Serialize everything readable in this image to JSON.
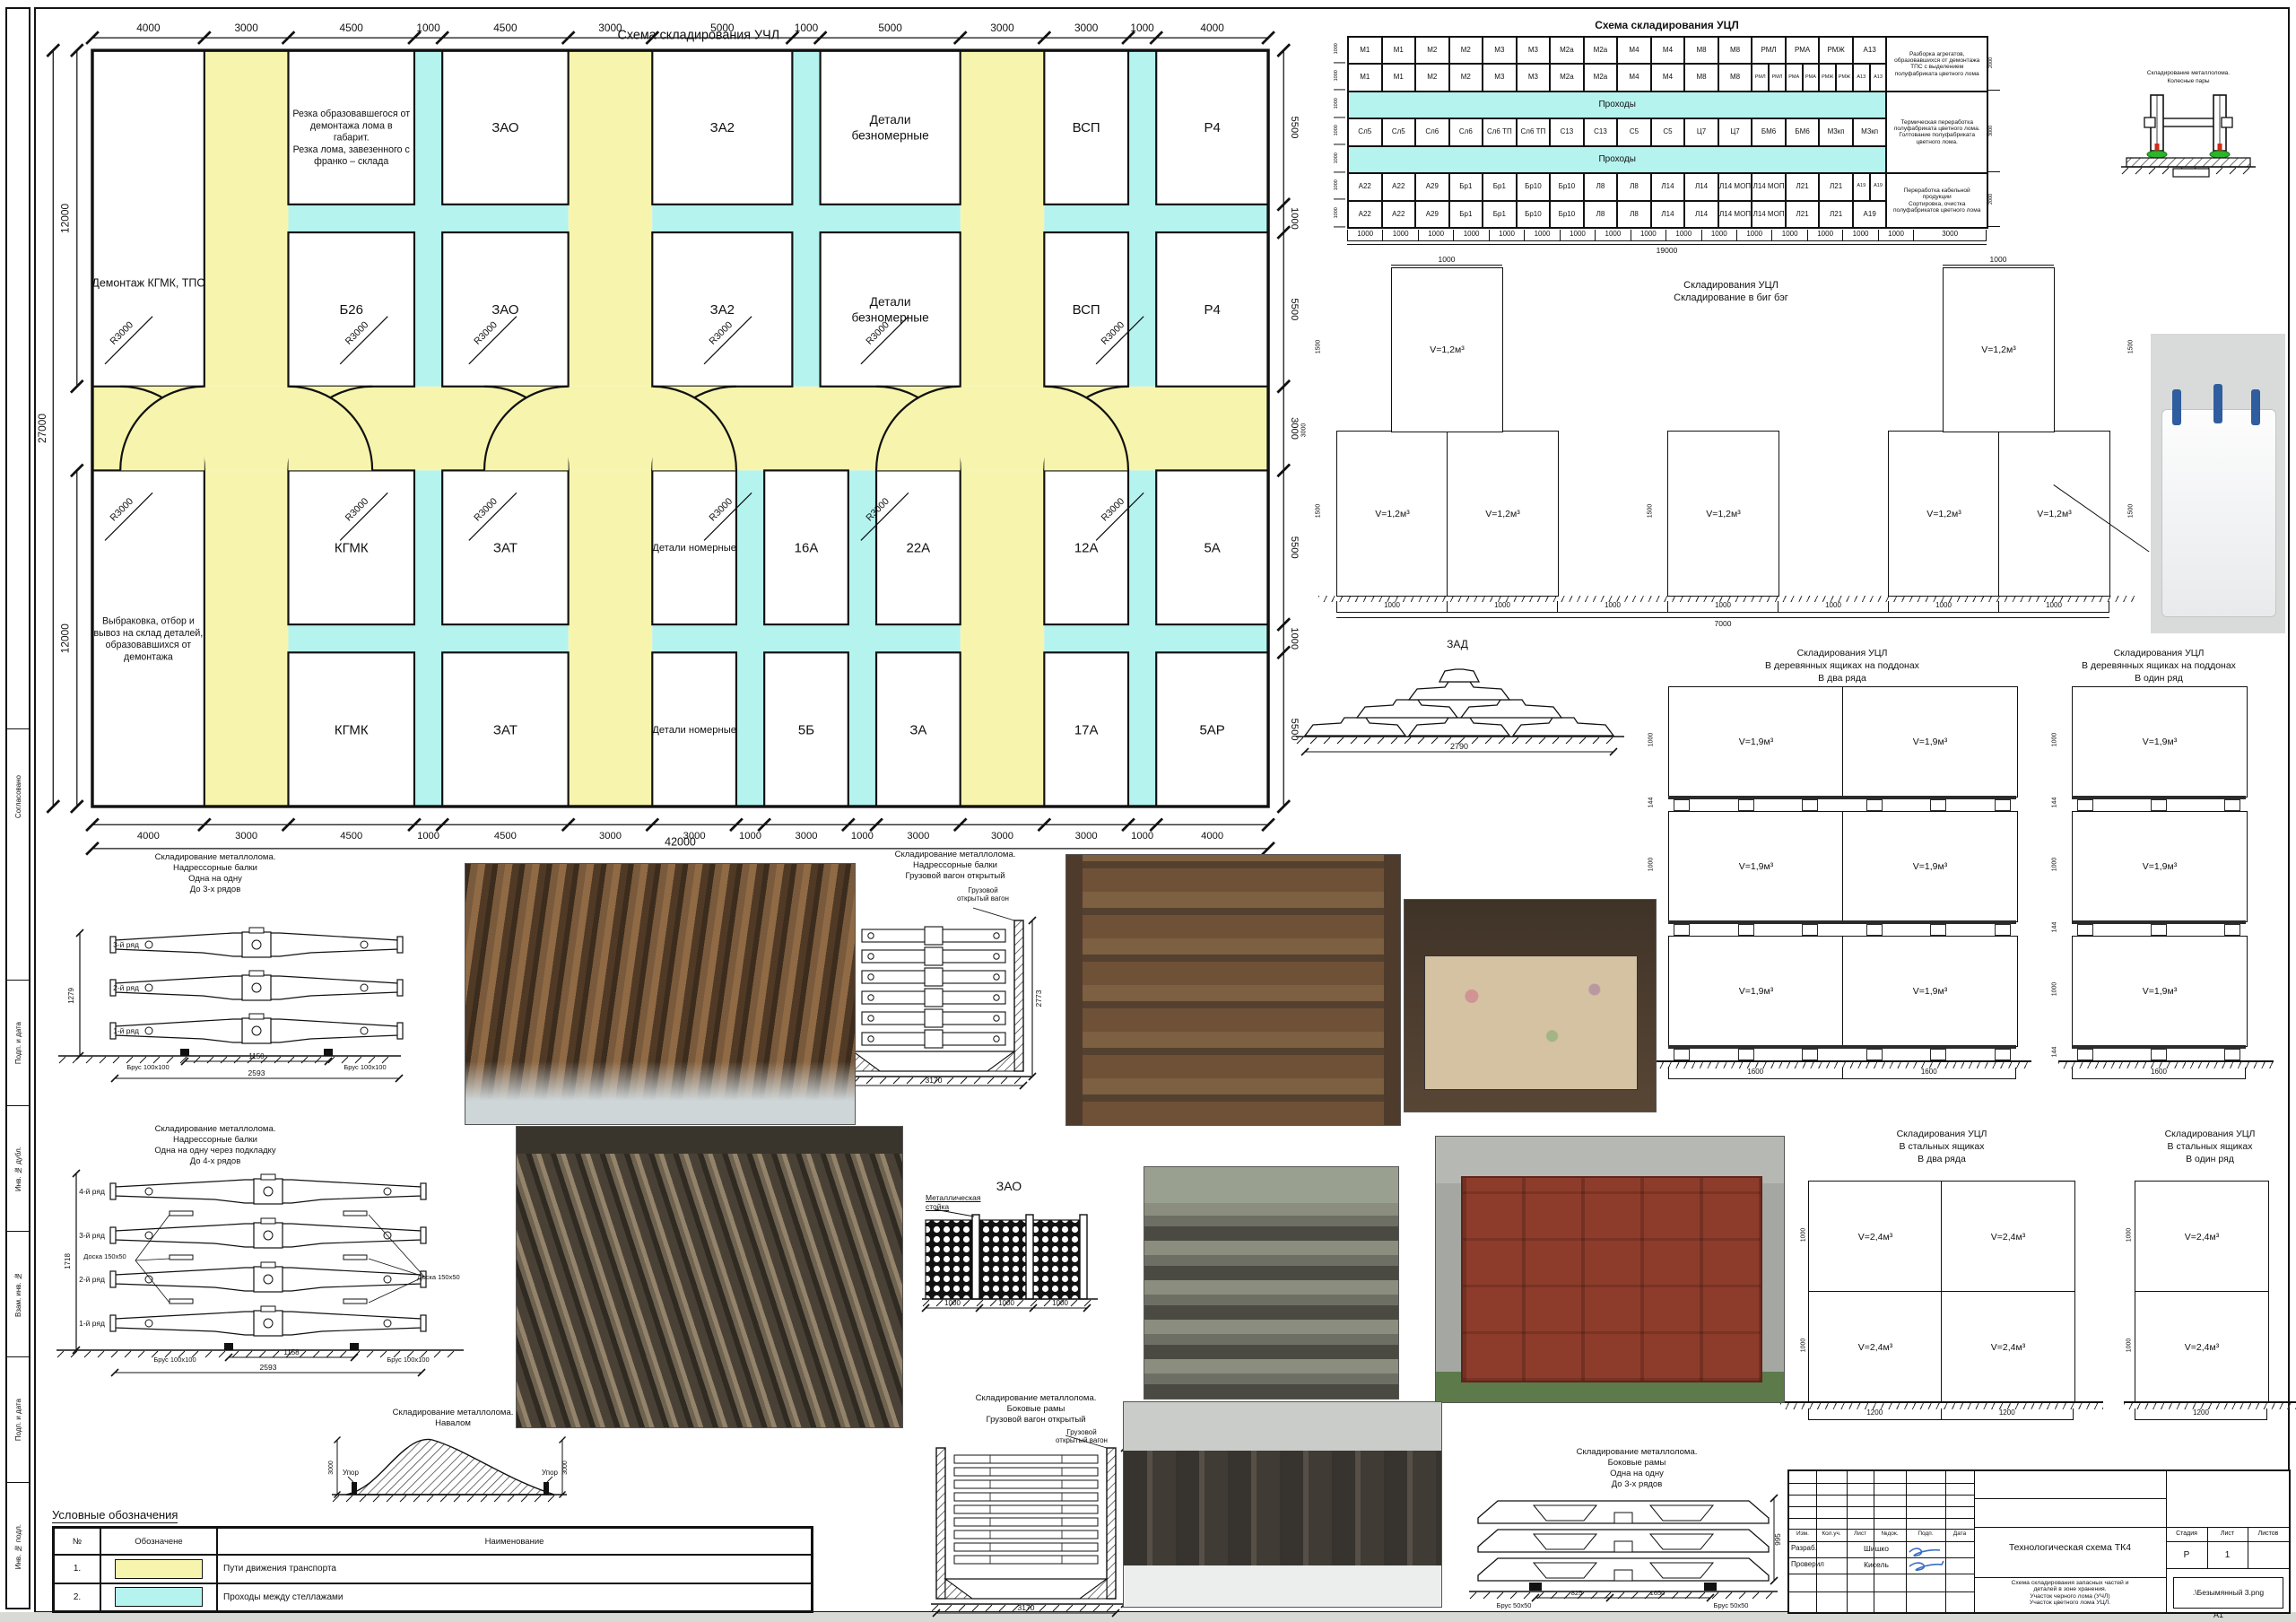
{
  "sheet": {
    "format_label": "А1"
  },
  "colors": {
    "path_yellow": "#f7f5ad",
    "aisle_cyan": "#b5f3ef",
    "line": "#141414",
    "signature_blue": "#3a6fc4"
  },
  "uchl": {
    "title": "Схема складирования УЧЛ",
    "top_dims": [
      4000,
      3000,
      4500,
      1000,
      4500,
      3000,
      5000,
      1000,
      5000,
      3000,
      3000,
      1000,
      4000
    ],
    "bottom_dims": [
      4000,
      3000,
      4500,
      1000,
      4500,
      3000,
      3000,
      1000,
      3000,
      1000,
      3000,
      3000,
      3000,
      1000,
      4000
    ],
    "bottom_total": "42000",
    "left_top": "12000",
    "left_total": "27000",
    "left_bottom": "12000",
    "right_dims": [
      "5500",
      "1000",
      "5500",
      "3000",
      "5500",
      "1000",
      "5500"
    ],
    "radius_label": "R3000",
    "cell_demontazh": "Демонтаж КГМК, ТПС",
    "cell_rezka": "Резка образовавшегося от\nдемонтажа лома в\nгабарит.\nРезка лома, завезенного с\nфранко – склада",
    "cell_vybrakovka": "Выбраковка, отбор и\nвывоз на склад деталей,\nобразовавшихся от\nдемонтажа",
    "row1": [
      "ЗАО",
      "ЗА2",
      "Детали\nбезномерные",
      "ВСП",
      "Р4"
    ],
    "row2": [
      "Б26",
      "ЗАО",
      "ЗА2",
      "Детали\nбезномерные",
      "ВСП",
      "Р4"
    ],
    "row3": [
      "КГМК",
      "ЗАТ",
      "Детали номерные",
      "16А",
      "22А",
      "12А",
      "5А"
    ],
    "row4": [
      "КГМК",
      "ЗАТ",
      "Детали номерные",
      "5Б",
      "ЗА",
      "17А",
      "5АР"
    ]
  },
  "ucl_table": {
    "title": "Схема складирования УЦЛ",
    "rows": [
      {
        "cells": [
          {
            "t": "М1"
          },
          {
            "t": "М1"
          },
          {
            "t": "М2"
          },
          {
            "t": "М2"
          },
          {
            "t": "М3"
          },
          {
            "t": "М3"
          },
          {
            "t": "М2а"
          },
          {
            "t": "М2а"
          },
          {
            "t": "М4"
          },
          {
            "t": "М4"
          },
          {
            "t": "М8"
          },
          {
            "t": "М8"
          },
          {
            "t": "РМЛ"
          },
          {
            "t": "РМА"
          },
          {
            "t": "РМЖ"
          },
          {
            "t": "А13"
          },
          {
            "t": "Разборка агрегатов, образовавшихся от демонтажа ТПС с выделением полуфабриката цветного лома",
            "side": true,
            "rspan": 2
          }
        ]
      },
      {
        "cells": [
          {
            "t": "М1"
          },
          {
            "t": "М1"
          },
          {
            "t": "М2"
          },
          {
            "t": "М2"
          },
          {
            "t": "М3"
          },
          {
            "t": "М3"
          },
          {
            "t": "М2а"
          },
          {
            "t": "М2а"
          },
          {
            "t": "М4"
          },
          {
            "t": "М4"
          },
          {
            "t": "М8"
          },
          {
            "t": "М8"
          },
          {
            "t": "РМЛ",
            "half": true
          },
          {
            "t": "РМЛ",
            "half": true
          },
          {
            "t": "РМА",
            "half": true
          },
          {
            "t": "РМА",
            "half": true
          },
          {
            "t": "РМЖ",
            "half": true
          },
          {
            "t": "РМЖ",
            "half": true
          },
          {
            "t": "А13",
            "half": true
          },
          {
            "t": "А13",
            "half": true
          }
        ]
      },
      {
        "cells": [
          {
            "t": "Проходы",
            "passage": true
          },
          {
            "t": "Термическая переработка полуфабриката цветного лома.\nГолтование полуфабриката цветного лома.",
            "side": true,
            "rspan": 3
          }
        ]
      },
      {
        "cells": [
          {
            "t": "Сл5"
          },
          {
            "t": "Сл5"
          },
          {
            "t": "Сл6"
          },
          {
            "t": "Сл6"
          },
          {
            "t": "Сл6 ТП"
          },
          {
            "t": "Сл6 ТП"
          },
          {
            "t": "С13"
          },
          {
            "t": "С13"
          },
          {
            "t": "С5"
          },
          {
            "t": "С5"
          },
          {
            "t": "Ц7"
          },
          {
            "t": "Ц7"
          },
          {
            "t": "БМ6"
          },
          {
            "t": "БМ6"
          },
          {
            "t": "М3кп"
          },
          {
            "t": "М3кп"
          }
        ]
      },
      {
        "cells": [
          {
            "t": "Проходы",
            "passage": true
          }
        ]
      },
      {
        "cells": [
          {
            "t": "А22"
          },
          {
            "t": "А22"
          },
          {
            "t": "А29"
          },
          {
            "t": "Бр1"
          },
          {
            "t": "Бр1"
          },
          {
            "t": "Бр10"
          },
          {
            "t": "Бр10"
          },
          {
            "t": "Л8"
          },
          {
            "t": "Л8"
          },
          {
            "t": "Л14"
          },
          {
            "t": "Л14"
          },
          {
            "t": "Л14 МОП"
          },
          {
            "t": "Л14 МОП"
          },
          {
            "t": "Л21"
          },
          {
            "t": "Л21"
          },
          {
            "t": "А19",
            "half": true
          },
          {
            "t": "А19",
            "half": true
          },
          {
            "t": "Переработка кабельной продукции\nСортировка, очистка\nполуфабрикатов цветного лома",
            "side": true,
            "rspan": 2
          }
        ]
      },
      {
        "cells": [
          {
            "t": "А22"
          },
          {
            "t": "А22"
          },
          {
            "t": "А29"
          },
          {
            "t": "Бр1"
          },
          {
            "t": "Бр1"
          },
          {
            "t": "Бр10"
          },
          {
            "t": "Бр10"
          },
          {
            "t": "Л8"
          },
          {
            "t": "Л8"
          },
          {
            "t": "Л14"
          },
          {
            "t": "Л14"
          },
          {
            "t": "Л14 МОП"
          },
          {
            "t": "Л14 МОП"
          },
          {
            "t": "Л21"
          },
          {
            "t": "Л21"
          },
          {
            "t": "А19"
          }
        ]
      }
    ],
    "left_dims": [
      "1000",
      "1000",
      "1000",
      "1000",
      "1000",
      "1000",
      "1000"
    ],
    "right_dims": [
      "2000",
      "3000",
      "2000"
    ],
    "bottom_dims": [
      "1000",
      "1000",
      "1000",
      "1000",
      "1000",
      "1000",
      "1000",
      "1000",
      "1000",
      "1000",
      "1000",
      "1000",
      "1000",
      "1000",
      "1000",
      "1000",
      "3000"
    ],
    "bottom_total": "19000"
  },
  "wheelset": {
    "caption1": "Складирование металлолома.",
    "caption2": "Колесные пары"
  },
  "bigbag": {
    "title1": "Складирования УЦЛ",
    "title2": "Складирование в биг бэг",
    "v": "V=1,2м³",
    "d1000": "1000",
    "d1500": "1500",
    "d3000": "3000",
    "bottom_dims": [
      "1000",
      "1000",
      "1000",
      "1000",
      "1000",
      "1000",
      "1000"
    ],
    "bottom_total": "7000"
  },
  "zad": {
    "title": "ЗАД",
    "width": "2790"
  },
  "wood_two": {
    "t1": "Складирования УЦЛ",
    "t2": "В деревянных ящиках на поддонах",
    "t3": "В два ряда",
    "v": "V=1,9м³",
    "h_box": "1000",
    "h_pallet": "144",
    "bottom": [
      "1600",
      "1600"
    ]
  },
  "wood_one": {
    "t1": "Складирования УЦЛ",
    "t2": "В деревянных ящиках на поддонах",
    "t3": "В один ряд",
    "v": "V=1,9м³",
    "h_box": "1000",
    "h_pallet": "144",
    "bottom": [
      "1600"
    ]
  },
  "steel_two": {
    "t1": "Складирования УЦЛ",
    "t2": "В стальных ящиках",
    "t3": "В два ряда",
    "v": "V=2,4м³",
    "h": "1000",
    "bottom": [
      "1200",
      "1200"
    ]
  },
  "steel_one": {
    "t1": "Складирования УЦЛ",
    "t2": "В стальных ящиках",
    "t3": "В один ряд",
    "v": "V=2,4м³",
    "h": "1000",
    "bottom": [
      "1200"
    ]
  },
  "stack3": {
    "t": [
      "Складирование металлолома.",
      "Надрессорные балки",
      "Одна на одну",
      "До 3-х рядов"
    ],
    "rows": [
      "3-й ряд",
      "2-й ряд",
      "1-й ряд"
    ],
    "height": "1279",
    "brus": "Брус 100х100",
    "dim_mid": "1150",
    "dim_total": "2593"
  },
  "stack4": {
    "t": [
      "Складирование металлолома.",
      "Надрессорные балки",
      "Одна на одну через подкладку",
      "До 4-х рядов"
    ],
    "rows": [
      "4-й ряд",
      "3-й ряд",
      "2-й ряд",
      "1-й ряд"
    ],
    "height": "1718",
    "doska": "Доска 150х50",
    "brus": "Брус 100х100",
    "dim_mid": "1158",
    "dim_total": "2593"
  },
  "wagon_bolster": {
    "t": [
      "Складирование металлолома.",
      "Надрессорные балки",
      "Грузовой вагон открытый"
    ],
    "callout": "Грузовой\nоткрытый вагон",
    "h": "2773",
    "w": "3170"
  },
  "zao": {
    "title": "ЗАО",
    "callout": "Металлическая\nстойка",
    "dims": [
      "1000",
      "1000",
      "1000"
    ]
  },
  "mound": {
    "t": [
      "Складирование металлолома.",
      "Навалом"
    ],
    "upor": "Упор",
    "h": "3000"
  },
  "wagon_frames": {
    "t": [
      "Складирование металлолома.",
      "Боковые рамы",
      "Грузовой вагон открытый"
    ],
    "callout": "Грузовой\nоткрытый вагон",
    "h": "2773",
    "w": "3170"
  },
  "stack_frames": {
    "t": [
      "Складирование металлолома.",
      "Боковые рамы",
      "Одна на одну",
      "До 3-х рядов"
    ],
    "height": "995",
    "brus": "Брус 50х50",
    "dim1": "825",
    "dim2": "1650"
  },
  "legend": {
    "title": "Условные обозначения",
    "col_num": "№",
    "col_sym": "Обозначене",
    "col_name": "Наименование",
    "rows": [
      {
        "n": "1.",
        "name": "Пути движения транспорта",
        "color": "#f7f5ad"
      },
      {
        "n": "2.",
        "name": "Проходы между стеллажами",
        "color": "#b5f3ef"
      }
    ]
  },
  "titleblock": {
    "cols": [
      "Изм.",
      "Кол.уч.",
      "Лист",
      "№док.",
      "Подп.",
      "Дата"
    ],
    "r1l": "Разраб.",
    "r1v": "Шишко",
    "r2l": "Проверил",
    "r2v": "Кисель",
    "title": "Технологическая схема ТК4",
    "subtitle": "Схема складирования запасных частей и\nдеталей в зоне хранения.\nУчасток черного лома (УЧЛ)\nУчасток цветного лома УЦЛ.",
    "stage_h": "Стадия",
    "sheet_h": "Лист",
    "sheets_h": "Листов",
    "stage": "Р",
    "sheet": "1",
    "file": ".\\Безымянный 3.png"
  },
  "margins": {
    "labels": [
      "Согласовано",
      "Подп. и дата",
      "Инв. № дубл.",
      "Взам. инв. №",
      "Подп. и дата",
      "Инв. № подл."
    ]
  }
}
